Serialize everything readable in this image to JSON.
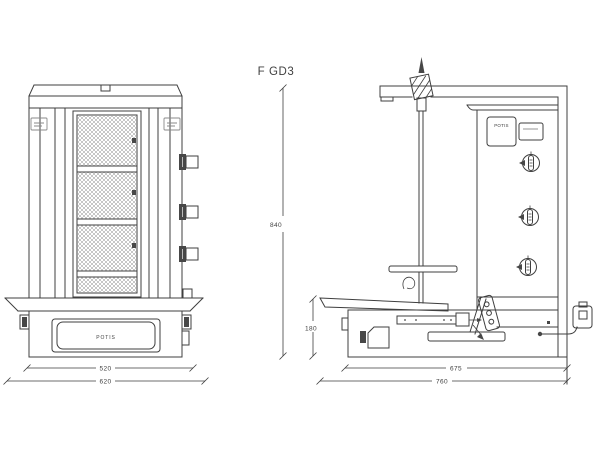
{
  "document": {
    "kind": "technical-drawing",
    "background": "#ffffff",
    "line_color": "#3f3f3f"
  },
  "labels": {
    "title": "F GD3",
    "front_drawer_brand": "POTIS",
    "side_plate_brand": "POTIS"
  },
  "dimensions": {
    "front_inner_width": "520",
    "front_overall_width": "620",
    "side_overall_height": "840",
    "side_base_height": "180",
    "side_body_depth": "675",
    "side_overall_depth": "760"
  }
}
